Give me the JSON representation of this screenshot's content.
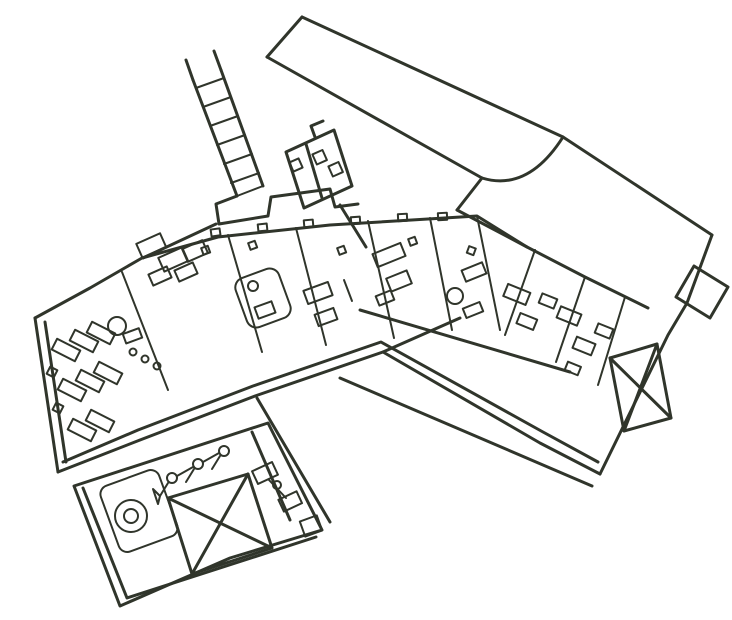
{
  "canvas": {
    "width": 732,
    "height": 620
  },
  "style": {
    "background": "#ffffff",
    "ink": "#30352b",
    "wall_stroke": 3,
    "detail_stroke": 2
  },
  "figure": {
    "kind": "hand-drawn architectural floor-plan sketch, rotated diagonally",
    "text_content": ""
  }
}
